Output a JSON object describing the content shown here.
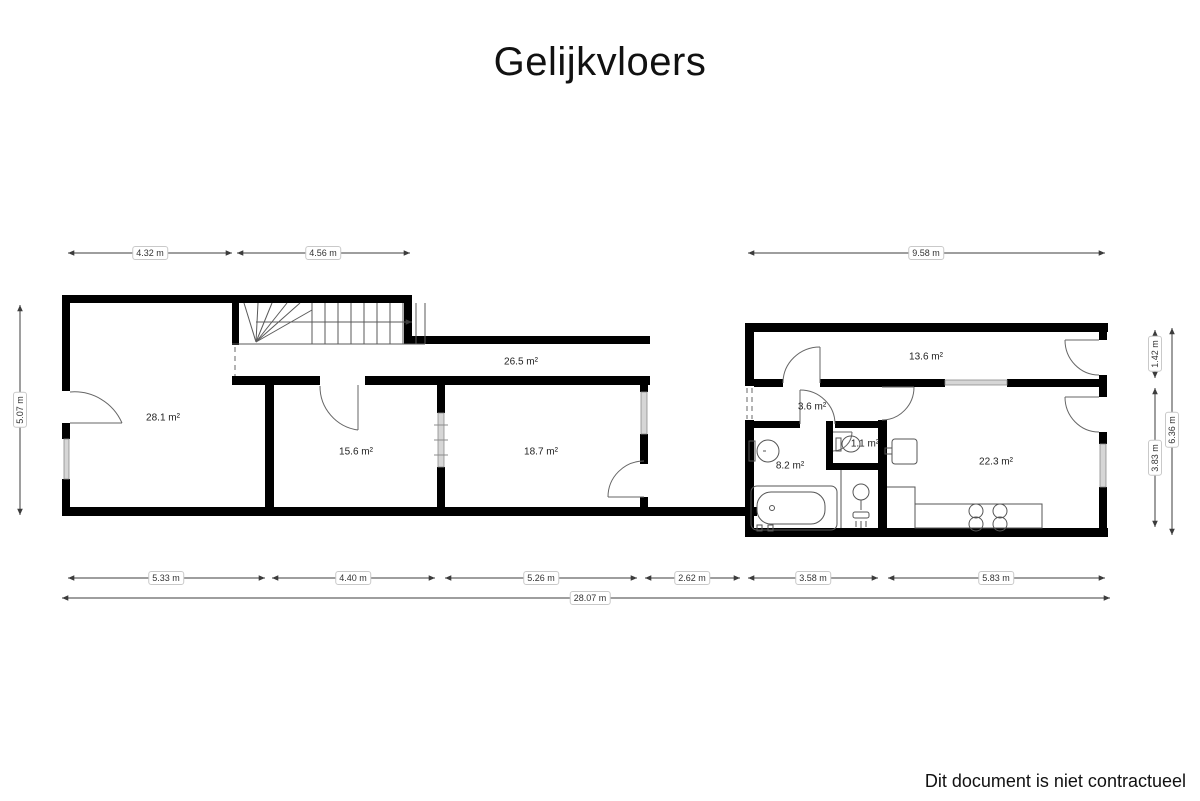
{
  "title": "Gelijkvloers",
  "footer_note": "Dit document is niet contractueel",
  "rooms": [
    {
      "id": "room-28-1",
      "label": "28.1 m²"
    },
    {
      "id": "room-15-6",
      "label": "15.6 m²"
    },
    {
      "id": "room-18-7",
      "label": "18.7 m²"
    },
    {
      "id": "hallway-26-5",
      "label": "26.5 m²"
    },
    {
      "id": "corridor-13-6",
      "label": "13.6 m²"
    },
    {
      "id": "hall-3-6",
      "label": "3.6 m²"
    },
    {
      "id": "wc-1-1",
      "label": "1.1 m²"
    },
    {
      "id": "bathroom-8-2",
      "label": "8.2 m²"
    },
    {
      "id": "kitchen-22-3",
      "label": "22.3 m²"
    }
  ],
  "dimensions": {
    "top": [
      {
        "label": "4.32 m"
      },
      {
        "label": "4.56 m"
      },
      {
        "label": "9.58 m"
      }
    ],
    "bottom": [
      {
        "label": "5.33 m"
      },
      {
        "label": "4.40 m"
      },
      {
        "label": "5.26 m"
      },
      {
        "label": "2.62 m"
      },
      {
        "label": "3.58 m"
      },
      {
        "label": "5.83 m"
      }
    ],
    "overall": {
      "label": "28.07 m"
    },
    "left": {
      "label": "5.07 m"
    },
    "right_inner": [
      {
        "label": "1.42 m"
      },
      {
        "label": "3.83 m"
      }
    ],
    "right_outer": {
      "label": "6.36 m"
    }
  },
  "colors": {
    "wall": "#000000",
    "thin_line": "#5a5a5a",
    "window_fill": "#d6d6d6",
    "window_edge": "#8c8c8c",
    "dimension_line": "#3c3c3c",
    "label_border": "#c9c9c9"
  }
}
